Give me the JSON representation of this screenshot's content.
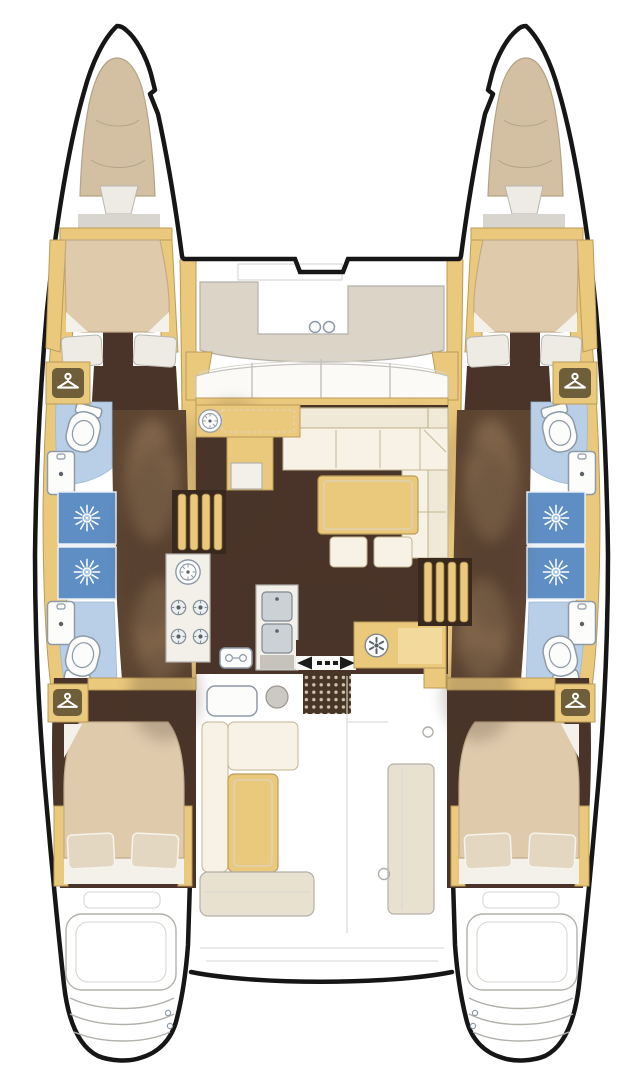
{
  "vessel": {
    "description": "Top-view floor plan of a four-cabin sailing catamaran"
  },
  "colors": {
    "background": "#ffffff",
    "hull_outline": "#161616",
    "deck_tan": "#eac87c",
    "deck_tan_edge": "#bb9c58",
    "deck_tan_light": "#f2d99c",
    "cushion": "#d3c0a3",
    "cushion_edge": "#b4a386",
    "mattress": "#dfcaac",
    "mattress_edge": "#c2ab89",
    "pillow_white": "#edebe4",
    "pillow_tan": "#e4d7c1",
    "sheet_white": "#f4f1ea",
    "floor_brown": "#4a3429",
    "corridor_brown": "#5d4532",
    "sheen": "#a98a66",
    "bath_blue": "#b8cfe7",
    "shower_blue": "#5e8ec3",
    "fixture_white": "#fcfcfa",
    "fixture_line": "#8d9aa8",
    "sofa_cream": "#f0e9d7",
    "sofa_edge": "#c3b592",
    "seat_white": "#f7f2e5",
    "table_tan": "#eac87c",
    "counter_white": "#f3f0ea",
    "steel": "#ccd1d5",
    "steel_line": "#7f8890",
    "gray_line": "#b3b0aa",
    "faint_line": "#d9d6d0",
    "pad_gray": "#dbd4c7",
    "bench_beige": "#e8e1d0",
    "mat_brown": "#473625",
    "mat_dot": "#cfc5ae",
    "arrow": "#1c1c1c",
    "olive": "#6f5e3a"
  },
  "icons": {
    "wardrobe": "hanger-icon",
    "shower": "shower-jet-icon",
    "toilet": "toilet-icon",
    "washbasin": "sink-icon",
    "cooktop": "burner-icon",
    "galley_sink": "round-sink-icon",
    "aft_hob": "spoked-hob-icon",
    "deck_hatch": "hatch-icon",
    "sliding_door": "double-arrow-icon"
  },
  "layout": {
    "hulls": {
      "port": {
        "rooms": [
          "forepeak berth",
          "forward double cabin with two pillows",
          "forward head: toilet and washbasin",
          "two shower stalls",
          "aft head: washbasin and toilet",
          "two wardrobes with hanger icons",
          "aft double cabin with two pillows",
          "transom swim steps"
        ]
      },
      "starboard": {
        "mirror_of": "port"
      }
    },
    "bridgedeck": {
      "areas": [
        "foredeck sun lounge with two round deck hatches",
        "curved windshield with mullions",
        "saloon: L-shaped sofa, rectangular table, two ottomans",
        "galley: round sink, 4-burner cooktop, double stainless sink",
        "port companionway stairs",
        "starboard companionway stairs",
        "sliding door marked with opposing arrows",
        "doormat with dot grid",
        "aft galley counter with spoked hob",
        "cockpit: side bench, forward bench, cockpit table, helm module",
        "aft cockpit bench",
        "transom crossbeam"
      ]
    },
    "fixtures_per_hull": {
      "toilets": 2,
      "washbasins": 2,
      "showers": 2,
      "double_berths": 2,
      "wardrobes": 2
    }
  }
}
